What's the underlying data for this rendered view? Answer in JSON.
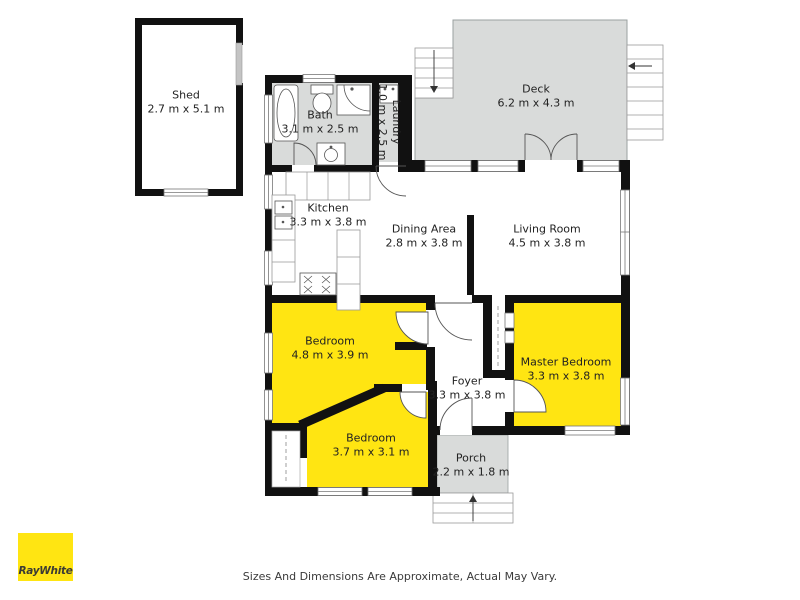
{
  "document": {
    "type": "floor-plan",
    "footer_disclaimer": "Sizes And Dimensions Are Approximate, Actual May Vary.",
    "logo": {
      "brand": "RayWhite"
    },
    "colors": {
      "highlight_room_yellow": "#FFE512",
      "area_gray": "#D9DBDA",
      "wall_black": "#111111",
      "logo_yellow": "#FFE512",
      "logo_text": "#3B3B34"
    }
  },
  "rooms": [
    {
      "id": "shed",
      "name": "Shed",
      "dims": "2.7 m x 5.1 m",
      "fill": "white"
    },
    {
      "id": "bath",
      "name": "Bath",
      "dims": "3.1 m x 2.5 m",
      "fill": "gray"
    },
    {
      "id": "laundry",
      "name": "Laundry",
      "dims": "1.0 m x 2.5 m",
      "fill": "gray"
    },
    {
      "id": "deck",
      "name": "Deck",
      "dims": "6.2 m x 4.3 m",
      "fill": "gray"
    },
    {
      "id": "kitchen",
      "name": "Kitchen",
      "dims": "3.3 m x 3.8 m",
      "fill": "white"
    },
    {
      "id": "dining-area",
      "name": "Dining Area",
      "dims": "2.8 m x 3.8 m",
      "fill": "white"
    },
    {
      "id": "living-room",
      "name": "Living Room",
      "dims": "4.5 m x 3.8 m",
      "fill": "white"
    },
    {
      "id": "bedroom-1",
      "name": "Bedroom",
      "dims": "4.8 m x 3.9 m",
      "fill": "yellow"
    },
    {
      "id": "master-bedroom",
      "name": "Master Bedroom",
      "dims": "3.3 m x 3.8 m",
      "fill": "yellow"
    },
    {
      "id": "foyer",
      "name": "Foyer",
      "dims": "3.3 m x 3.8 m",
      "fill": "white"
    },
    {
      "id": "bedroom-2",
      "name": "Bedroom",
      "dims": "3.7 m x 3.1 m",
      "fill": "yellow"
    },
    {
      "id": "porch",
      "name": "Porch",
      "dims": "2.2 m x 1.8 m",
      "fill": "gray"
    }
  ]
}
